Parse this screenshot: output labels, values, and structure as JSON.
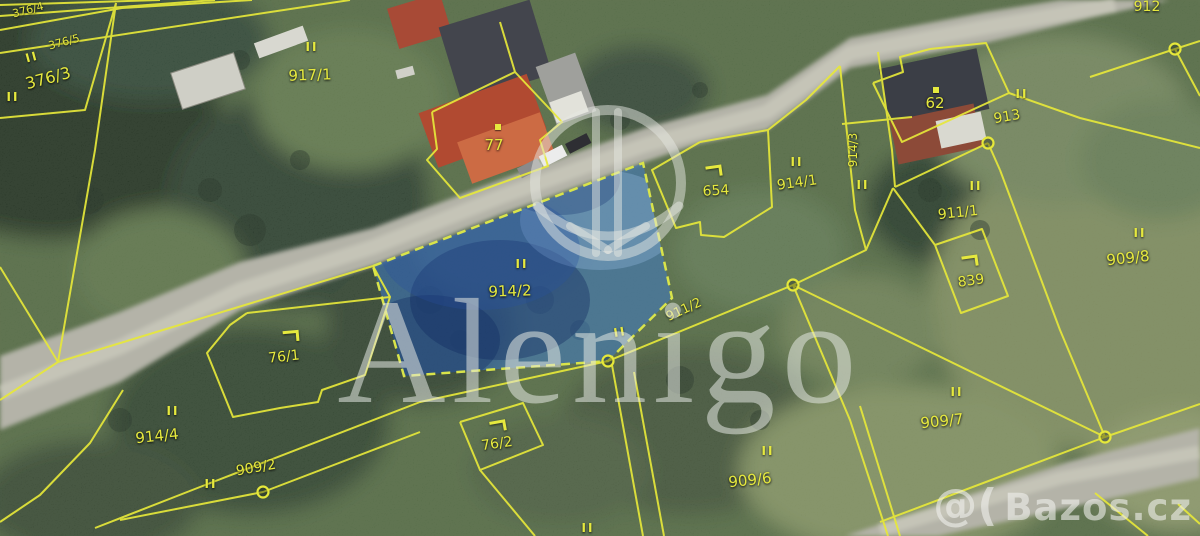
{
  "map": {
    "type": "cadastral-parcel-map-over-aerial-photo",
    "highlighted_parcel": "914/2",
    "colors": {
      "boundary": "#e6e83a",
      "label": "#e6e93e",
      "highlight_fill": "rgba(62,122,198,0.55)",
      "highlight_border": "#d9e44a",
      "road": "#b4b3a8"
    },
    "symbols": {
      "land_use": "II"
    },
    "parcel_labels": [
      {
        "label": "376/4",
        "x": 28,
        "y": 10,
        "rot": -15,
        "fs": 11
      },
      {
        "label": "376/5",
        "x": 64,
        "y": 42,
        "rot": -15,
        "fs": 11
      },
      {
        "label": "376/3",
        "x": 48,
        "y": 78,
        "rot": -15,
        "fs": 16
      },
      {
        "label": "917/1",
        "x": 310,
        "y": 75,
        "rot": -2,
        "fs": 15
      },
      {
        "label": "77",
        "x": 494,
        "y": 145,
        "rot": 0,
        "fs": 15
      },
      {
        "label": "654",
        "x": 716,
        "y": 191,
        "rot": -3,
        "fs": 14
      },
      {
        "label": "914/1",
        "x": 797,
        "y": 183,
        "rot": -8,
        "fs": 14
      },
      {
        "label": "914/3",
        "x": 853,
        "y": 150,
        "rot": -90,
        "fs": 12
      },
      {
        "label": "62",
        "x": 935,
        "y": 103,
        "rot": 0,
        "fs": 15
      },
      {
        "label": "913",
        "x": 1007,
        "y": 117,
        "rot": -10,
        "fs": 14
      },
      {
        "label": "912",
        "x": 1147,
        "y": 7,
        "rot": 0,
        "fs": 14
      },
      {
        "label": "911/1",
        "x": 958,
        "y": 213,
        "rot": -6,
        "fs": 14
      },
      {
        "label": "839",
        "x": 971,
        "y": 281,
        "rot": -8,
        "fs": 14
      },
      {
        "label": "909/8",
        "x": 1128,
        "y": 258,
        "rot": -6,
        "fs": 15
      },
      {
        "label": "914/2",
        "x": 510,
        "y": 291,
        "rot": -2,
        "fs": 15
      },
      {
        "label": "911/2",
        "x": 684,
        "y": 310,
        "rot": -25,
        "fs": 13
      },
      {
        "label": "76/1",
        "x": 284,
        "y": 357,
        "rot": -6,
        "fs": 14
      },
      {
        "label": "76/2",
        "x": 497,
        "y": 444,
        "rot": -8,
        "fs": 14
      },
      {
        "label": "914/4",
        "x": 157,
        "y": 436,
        "rot": -6,
        "fs": 15
      },
      {
        "label": "909/2",
        "x": 256,
        "y": 468,
        "rot": -10,
        "fs": 14
      },
      {
        "label": "909/7",
        "x": 942,
        "y": 421,
        "rot": -6,
        "fs": 15
      },
      {
        "label": "909/6",
        "x": 750,
        "y": 480,
        "rot": -6,
        "fs": 15
      }
    ],
    "landuse_marks": [
      {
        "x": 32,
        "y": 57,
        "rot": -15
      },
      {
        "x": 13,
        "y": 97,
        "rot": 0
      },
      {
        "x": 312,
        "y": 47,
        "rot": 0
      },
      {
        "x": 797,
        "y": 162,
        "rot": 0
      },
      {
        "x": 863,
        "y": 185,
        "rot": 0
      },
      {
        "x": 1022,
        "y": 94,
        "rot": 0
      },
      {
        "x": 976,
        "y": 186,
        "rot": 0
      },
      {
        "x": 1140,
        "y": 233,
        "rot": 0
      },
      {
        "x": 522,
        "y": 264,
        "rot": 0
      },
      {
        "x": 620,
        "y": 332,
        "rot": -10
      },
      {
        "x": 173,
        "y": 411,
        "rot": 0
      },
      {
        "x": 211,
        "y": 484,
        "rot": 0
      },
      {
        "x": 957,
        "y": 392,
        "rot": 0
      },
      {
        "x": 768,
        "y": 451,
        "rot": 0
      },
      {
        "x": 588,
        "y": 528,
        "rot": 0
      }
    ],
    "hook_marks": [
      {
        "x": 714,
        "y": 171,
        "rot": -8
      },
      {
        "x": 970,
        "y": 261,
        "rot": -8
      },
      {
        "x": 291,
        "y": 336,
        "rot": -5
      },
      {
        "x": 498,
        "y": 426,
        "rot": -10
      }
    ],
    "dot_marks": [
      {
        "x": 498,
        "y": 127
      },
      {
        "x": 936,
        "y": 90
      }
    ]
  },
  "watermarks": {
    "brand_center": "Alenigo",
    "corner_logo": "@(",
    "brand_corner": "Bazos.cz"
  }
}
